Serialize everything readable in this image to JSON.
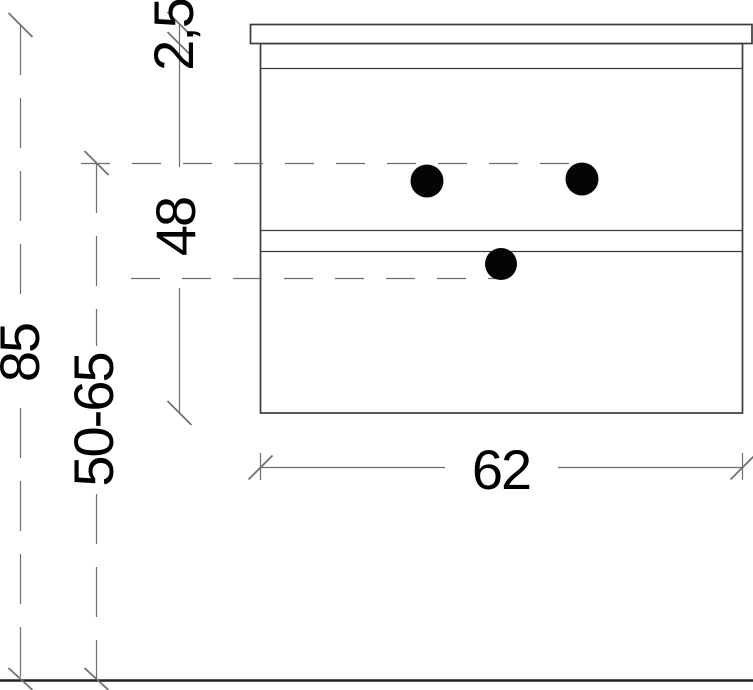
{
  "drawing": {
    "labels": {
      "overall_height": "85",
      "install_height_range": "50-65",
      "top_thickness": "2,5",
      "body_height": "48",
      "width": "62"
    },
    "colors": {
      "bg": "#ffffff",
      "outline": "#3c3c3c",
      "dim": "#6e6e6e",
      "dot": "#050505",
      "floor": "#222222",
      "text-color": "#000000"
    }
  }
}
